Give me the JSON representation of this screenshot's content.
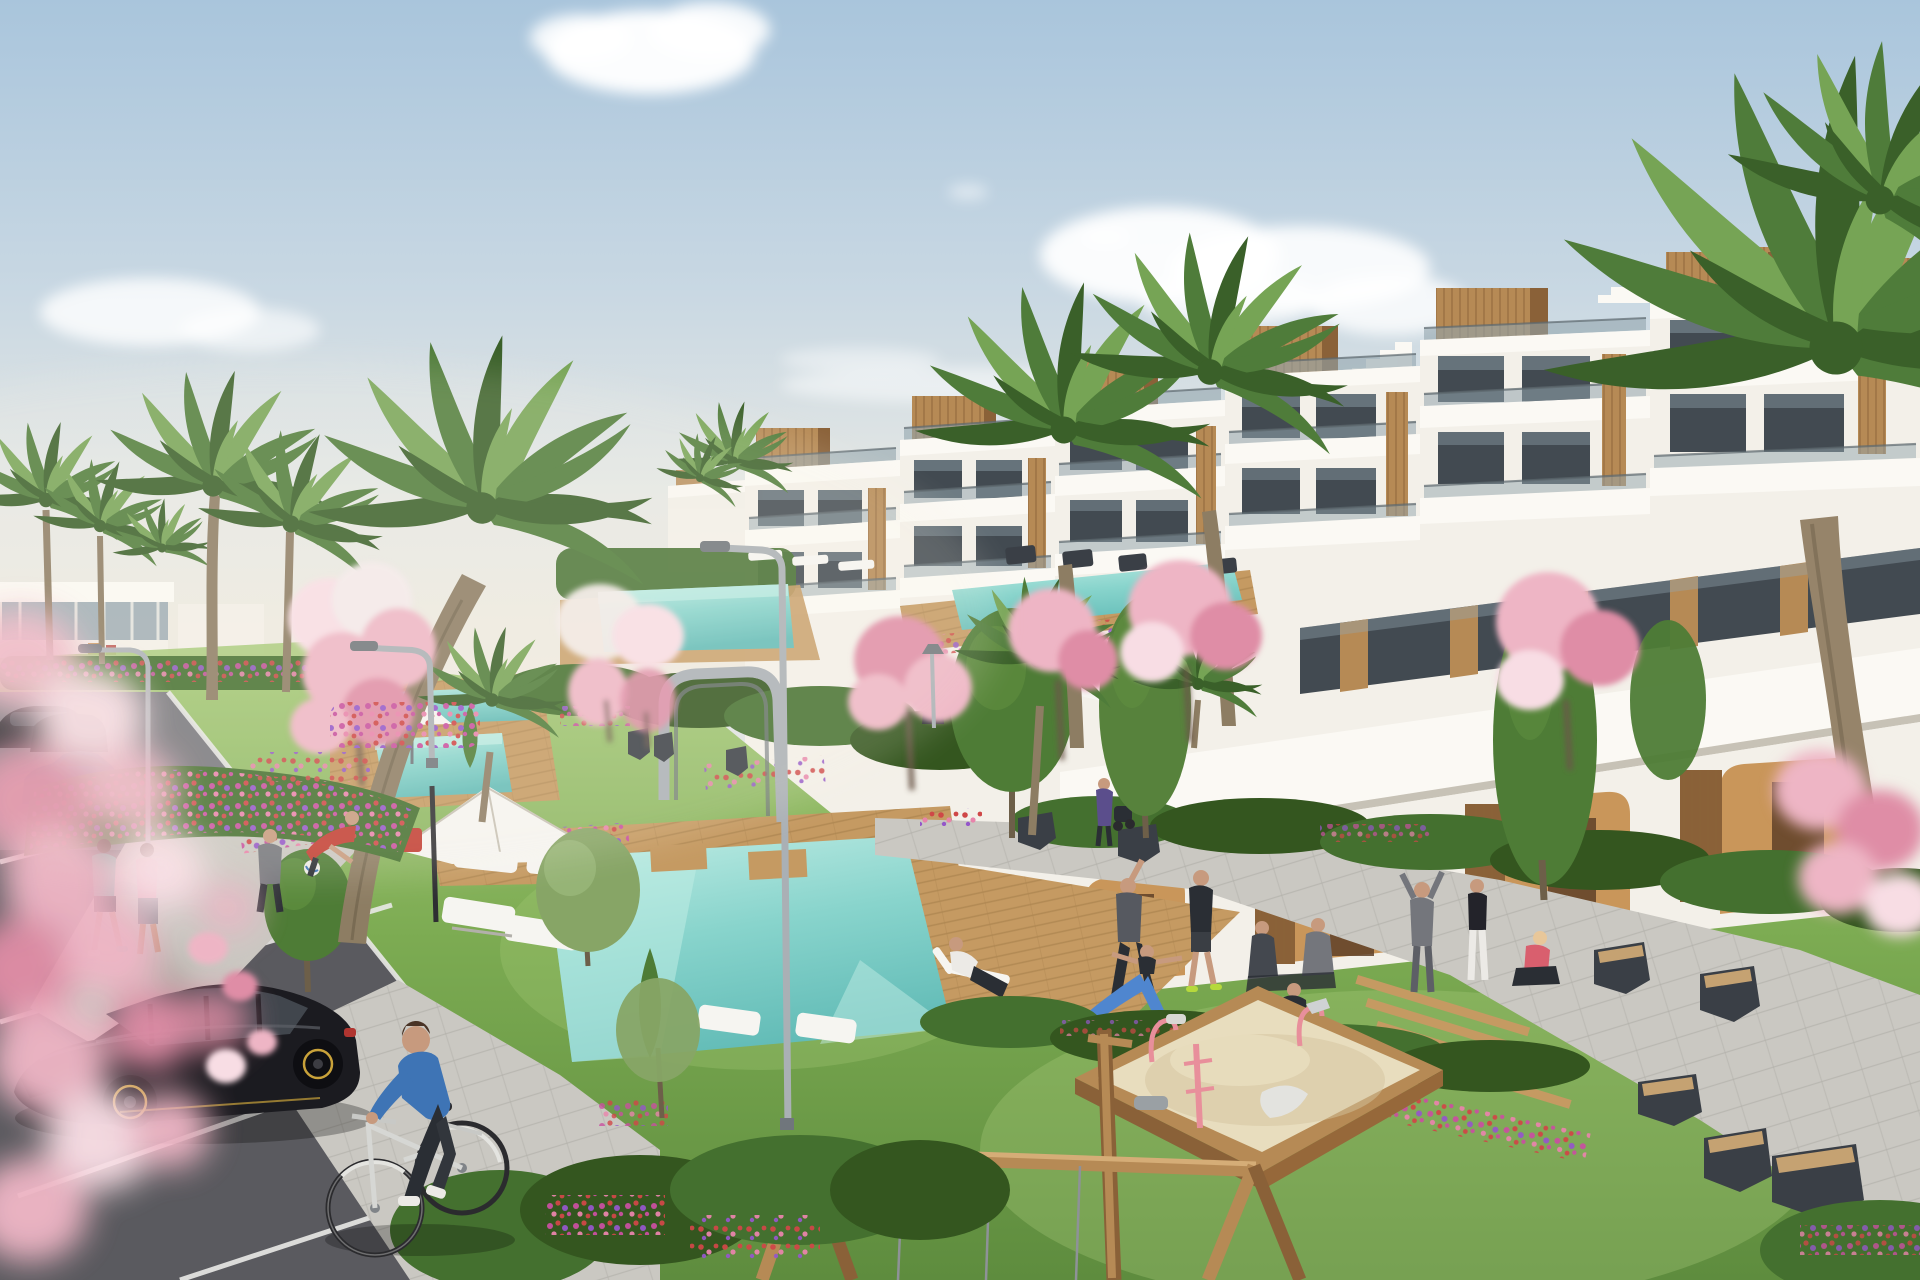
{
  "meta": {
    "kind": "architectural-3d-render",
    "description": "Sunny 3D rendering of a modern white terraced apartment complex with rooftop wooden volumes, glass balconies, palm trees, cherry-blossom trees, flower beds, lap pools, a large turquoise pool with wooden deck, white parasols and loungers, people exercising on lawns, a parking lot with cars, a cyclist, a playground sandbox and a wooden swing frame."
  },
  "scene": {
    "objects": [
      "sky",
      "clouds",
      "distant-building",
      "main-building",
      "rooftop-wood-boxes",
      "roof-stairs",
      "balcony-bands",
      "glass-railings",
      "arcade-arches",
      "ground-hedges",
      "lawns",
      "flower-beds",
      "lap-pool-north",
      "lap-pool-west",
      "pool-southwest",
      "main-pool",
      "pool-decks",
      "metal-arch",
      "parasols",
      "sun-loungers",
      "benches",
      "street-lamps",
      "palm-trees",
      "cherry-blossom-trees",
      "poplar-trees",
      "parking-lot",
      "black-hatchback",
      "blue-sedan",
      "distant-cars",
      "cyclist",
      "joggers",
      "yoga-group",
      "pedestrians",
      "sandbox",
      "swing-frame",
      "foreground-blossoms"
    ]
  },
  "palette": {
    "sky-top": "#a9c5dc",
    "sky-mid": "#c9d8e3",
    "sky-low": "#e6e8e4",
    "sky-horizon": "#f1ebdf",
    "cloud": "#ffffff",
    "bldg": "#f3f0e9",
    "bldg-bright": "#fbf9f4",
    "bldg-shade": "#e3dfd4",
    "bldg-line": "#c7c2b6",
    "wood": "#b68a55",
    "wood-dark": "#8a6138",
    "wood-light": "#d5ad77",
    "glass": "#424a51",
    "glass-light": "#93a5ae",
    "rail-line": "#5d686e",
    "ochre": "#c9965a",
    "ochre-dark": "#a8773f",
    "door-dark": "#5f4128",
    "hedge": "#44702f",
    "hedge-dark": "#34561f",
    "hedge-light": "#60903f",
    "grass": "#7cab52",
    "grass-light": "#a5c977",
    "grass-dark": "#5e8c3e",
    "deck": "#c59a62",
    "deck-dark": "#9d7845",
    "pool": "#88d4cc",
    "pool-light": "#bfece4",
    "pool-deep": "#63bcb7",
    "sand": "#e8ddbe",
    "sand-shade": "#d4c49e",
    "asphalt": "#5a5a5f",
    "asphalt-light": "#7e7e84",
    "road-line": "#e9e9e7",
    "path": "#cac8c2",
    "path-line": "#b2b0aa",
    "blossom": "#eeb5c5",
    "blossom-light": "#f8dde4",
    "blossom-deep": "#df8da6",
    "flower-red": "#cf4747",
    "flower-magenta": "#c8509f",
    "flower-purple": "#9457c9",
    "flower-pink": "#e884ab",
    "palm": "#4f7c3a",
    "palm-light": "#76a455",
    "palm-deep": "#3a6029",
    "trunk": "#8d7d63",
    "trunk-dark": "#6d5f49",
    "tree": "#4e7c36",
    "olive": "#87a566",
    "metal": "#aab0b5",
    "metal-dark": "#70767c",
    "bench": "#3a3f46",
    "car-black": "#1b1b20",
    "car-glass": "#41464d",
    "car-blue": "#35506c",
    "car-dark": "#26262c",
    "accent-yellow": "#c9a23a",
    "accent-red": "#b03530",
    "white": "#f6f5f1",
    "skin": "#c79a7e",
    "hair": "#4a3426",
    "cloth-blue": "#3e74b5",
    "cloth-dark": "#2a2e34",
    "cloth-gray": "#74767c",
    "cloth-red": "#c23c31",
    "cloth-teal": "#4fae9e",
    "cloth-pink": "#e2a9b6",
    "cloth-coral": "#d95f6e",
    "cloth-white": "#eceae6",
    "legging-blue": "#4f86cf",
    "shadow": "#2e4a22"
  }
}
